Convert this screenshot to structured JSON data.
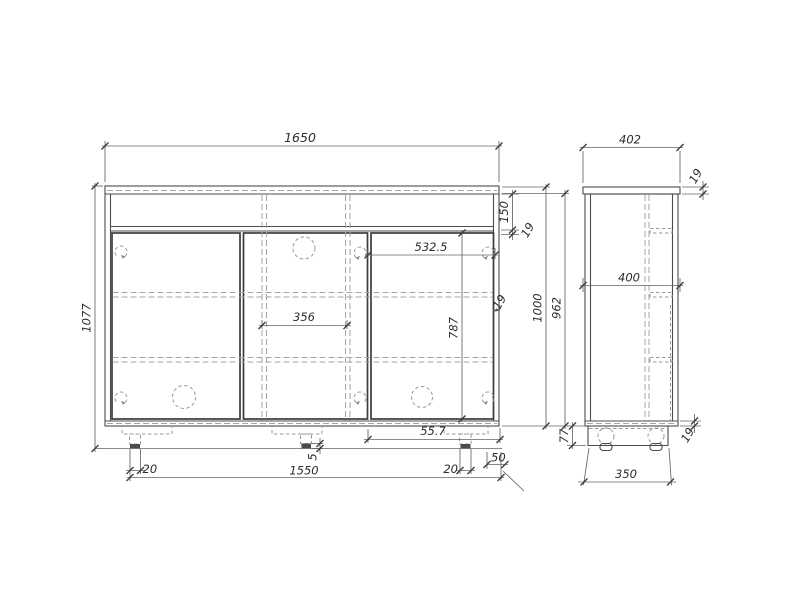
{
  "meta": {
    "title": "Sideboard cabinet technical drawing",
    "views": {
      "front_label": "front view",
      "side_label": "side view"
    }
  },
  "colors": {
    "background": "#ffffff",
    "solid_line": "#4c4c4c",
    "door_line": "#3c3c3c",
    "hidden_line": "#a5a5a5",
    "dimension_line": "#646464",
    "text": "#2d2d2d"
  },
  "dims": {
    "front": {
      "overall_width": "1650",
      "overall_height": "1077",
      "drawer_front_height": "150",
      "rail_thickness": "19",
      "right_door_width": "532.5",
      "partition_spacing": "356",
      "door_height": "787",
      "side_panel_thickness": "19",
      "carcass_height": "1000",
      "side_panel_height": "962",
      "bottom_offset": "55.7",
      "left_leg_width": "20",
      "foot_height": "5",
      "leg_span": "1550",
      "right_leg_width": "20",
      "right_leg_inset": "50"
    },
    "side": {
      "top_depth": "402",
      "top_thickness": "19",
      "panel_depth": "400",
      "base_height": "77",
      "bottom_thickness": "19",
      "base_depth": "350"
    }
  }
}
